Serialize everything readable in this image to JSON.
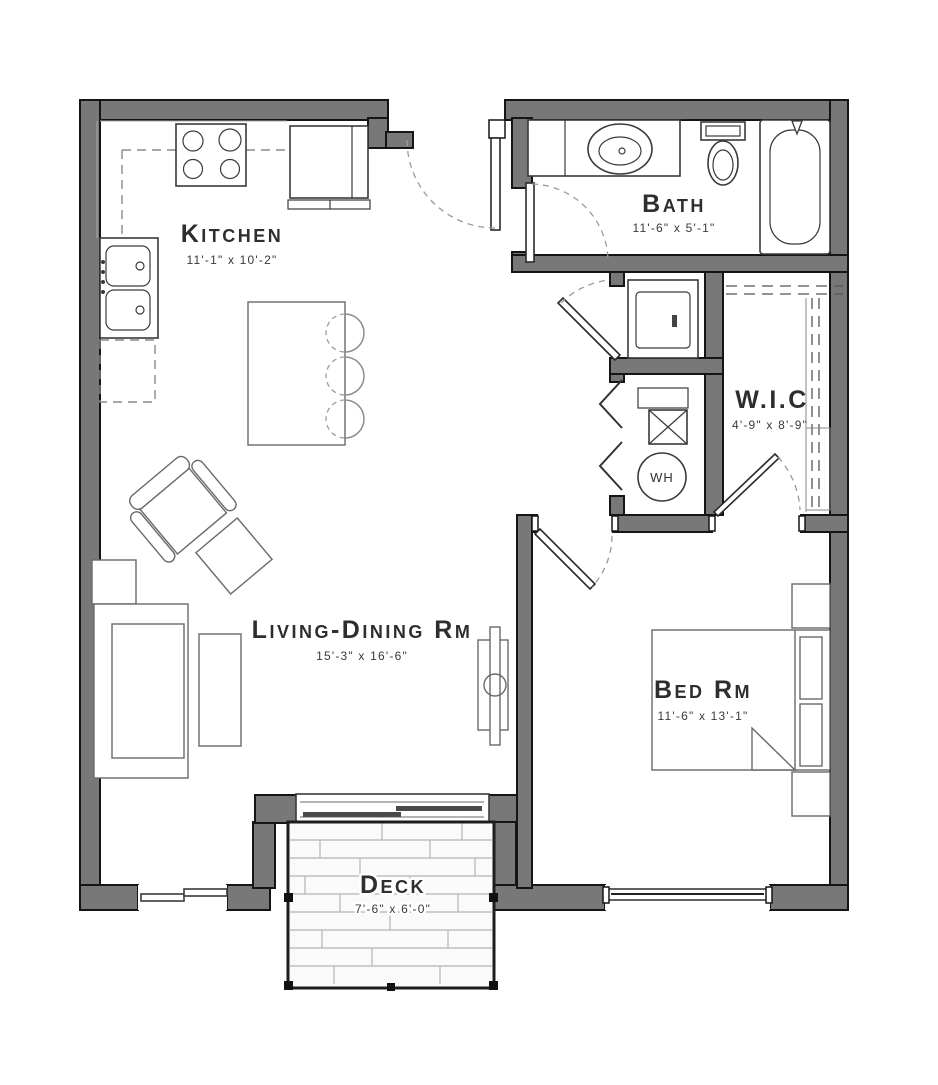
{
  "rooms": [
    {
      "label": "Kitchen",
      "dims": "11'-1\" x 10'-2\""
    },
    {
      "label": "Bath",
      "dims": "11'-6\" x 5'-1\""
    },
    {
      "label": "W.I.C",
      "dims": "4'-9\" x 8'-9\""
    },
    {
      "label": "Living-Dining Rm",
      "dims": "15'-3\" x 16'-6\""
    },
    {
      "label": "Bed Rm",
      "dims": "11'-6\" x 13'-1\""
    },
    {
      "label": "Deck",
      "dims": "7'-6\" x 6'-0\""
    }
  ],
  "fixtures": {
    "water_heater_label": "WH"
  },
  "colors": {
    "wall_fill": "#787878",
    "wall_stroke": "#151515",
    "label_text": "#2e2e2e",
    "furniture_stroke": "#6a6a6a",
    "deck_plank": "#b5b5b5"
  }
}
